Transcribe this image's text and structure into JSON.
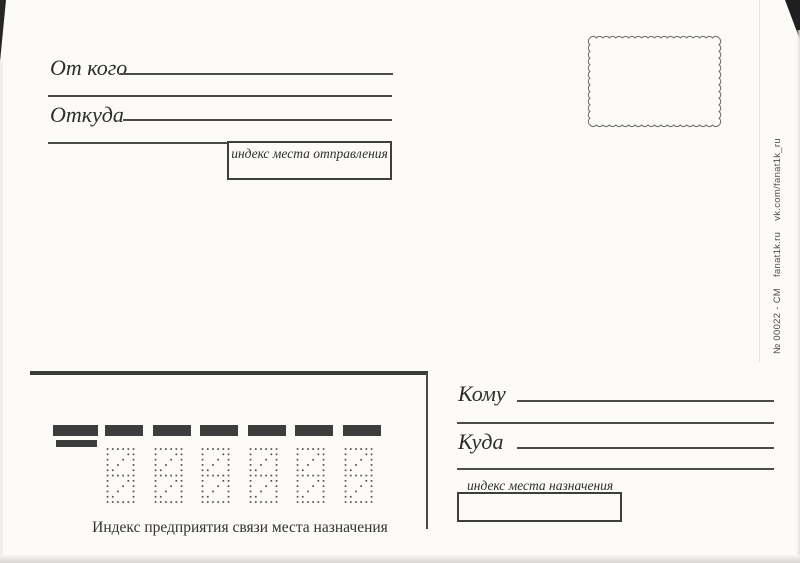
{
  "card": {
    "background": "#fcfbf7",
    "ink_color": "#3e3e3e",
    "bar_color": "#3d3d3d"
  },
  "sender_section": {
    "from_whom_label": "От кого",
    "from_where_label": "Откуда",
    "origin_index_label": "индекс места отправления"
  },
  "recipient_section": {
    "to_whom_label": "Кому",
    "to_where_label": "Куда",
    "destination_index_label": "индекс места назначения"
  },
  "index_zone": {
    "caption": "Индекс предприятия связи места назначения",
    "digit_cells": 6,
    "marker_bars": 7
  },
  "edge_strip": {
    "catalog_number": "№ 00022 - СМ",
    "site": "fanat1k.ru",
    "social": "vk.com/fanat1k_ru"
  }
}
